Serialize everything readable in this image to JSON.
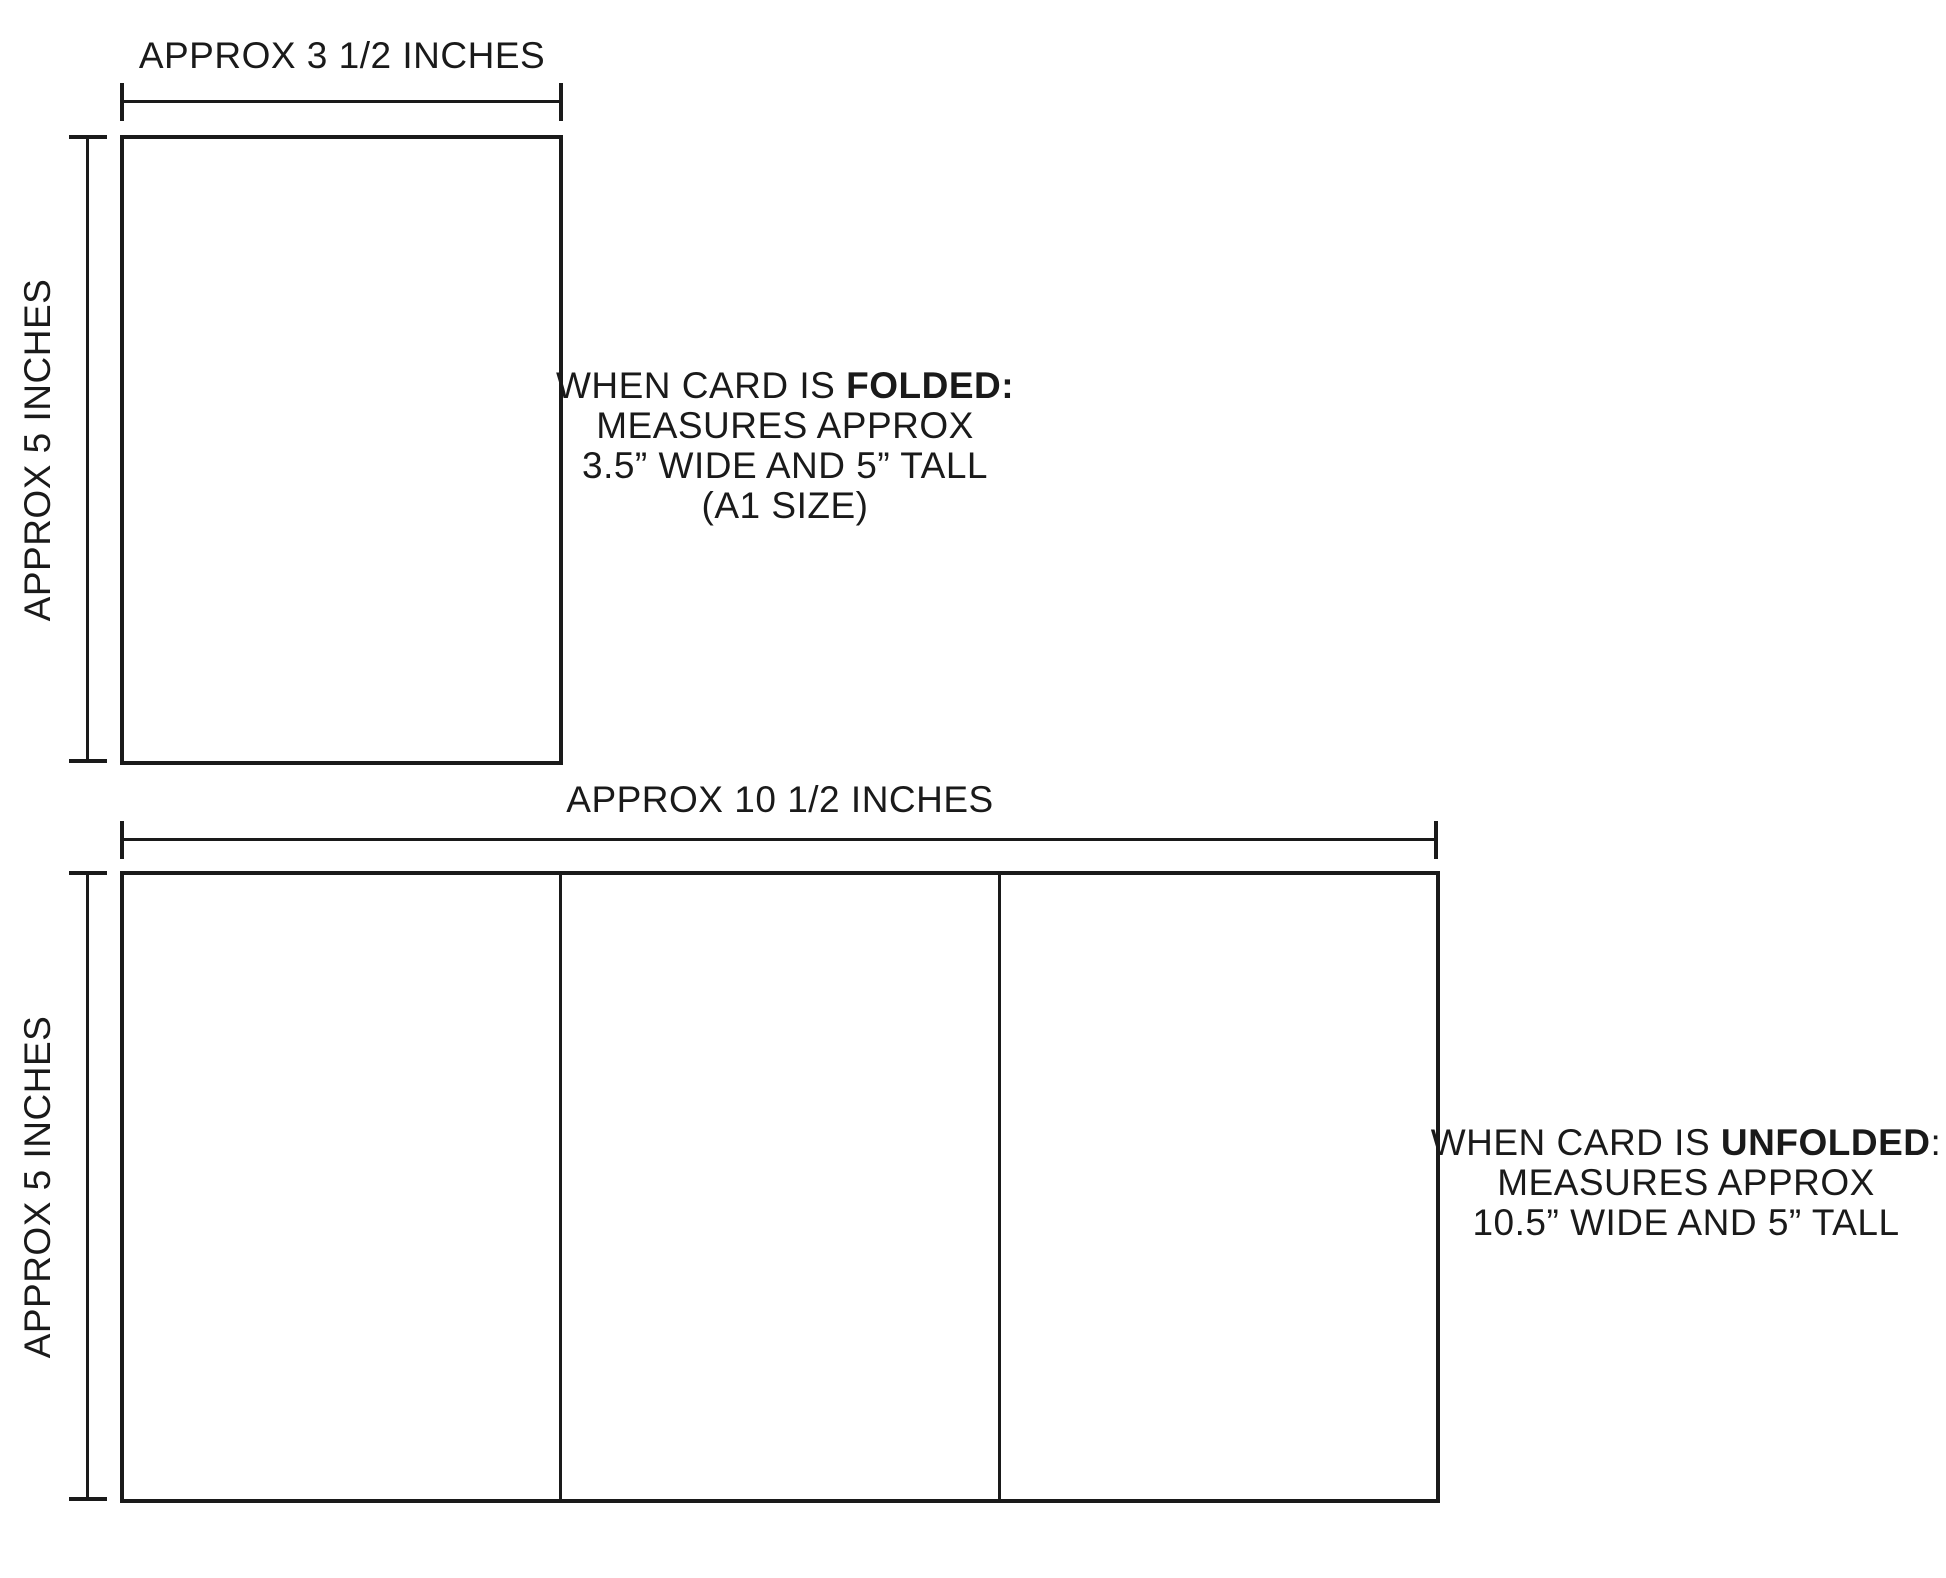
{
  "page": {
    "background": "#ffffff",
    "ink": "#1a1a1a"
  },
  "folded": {
    "width_label": "APPROX 3 1/2 INCHES",
    "height_label": "APPROX 5 INCHES",
    "note": {
      "line1_prefix": "WHEN CARD IS ",
      "line1_bold": "FOLDED:",
      "line1_suffix": "",
      "line2": "MEASURES APPROX",
      "line3": "3.5” WIDE AND 5” TALL",
      "line4": "(A1 SIZE)"
    }
  },
  "unfolded": {
    "width_label": "APPROX 10 1/2 INCHES",
    "height_label": "APPROX 5 INCHES",
    "note": {
      "line1_prefix": "WHEN CARD IS ",
      "line1_bold": "UNFOLDED",
      "line1_suffix": ":",
      "line2": "MEASURES APPROX",
      "line3": "10.5” WIDE AND 5” TALL"
    }
  }
}
